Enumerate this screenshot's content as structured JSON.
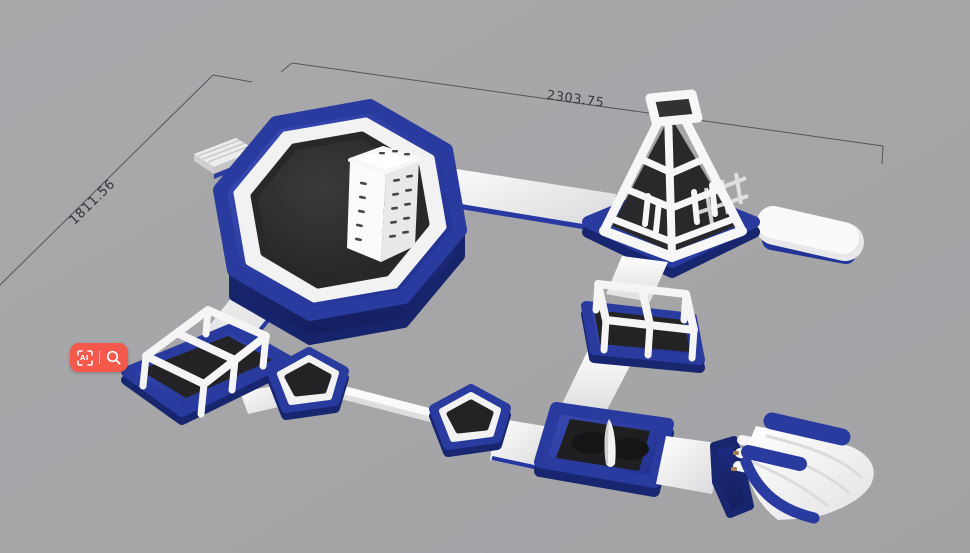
{
  "canvas": {
    "width": 970,
    "height": 553,
    "background_color": "#a6a6a9"
  },
  "annotations": {
    "width_label": "2303.75",
    "height_label": "1811.56",
    "line_color": "#56565a",
    "text_color": "#36363a"
  },
  "palette": {
    "inflatable_blue": "#2a3b9f",
    "inflatable_blue_dark": "#18266f",
    "inflatable_white": "#f2f2f3",
    "mat_dark": "#232325",
    "floor_gray": "#a6a6a9"
  },
  "toolbar": {
    "background_color": "#f4594c",
    "ai_label": "AI",
    "items": [
      {
        "name": "ai-translate",
        "icon": "ai-frame-icon"
      },
      {
        "name": "image-search",
        "icon": "magnifier-icon"
      }
    ]
  },
  "scene": {
    "description": "3D render of inflatable floating water park",
    "objects": [
      {
        "name": "octagon-trampoline"
      },
      {
        "name": "climbing-tower"
      },
      {
        "name": "boarding-dock"
      },
      {
        "name": "walkway-octagon-to-pyramid"
      },
      {
        "name": "climbing-pyramid"
      },
      {
        "name": "float-capsule"
      },
      {
        "name": "lattice-cube-left"
      },
      {
        "name": "lattice-cube-right"
      },
      {
        "name": "walkway-octagon-to-cube"
      },
      {
        "name": "pentagon-stepper-1"
      },
      {
        "name": "pentagon-stepper-2"
      },
      {
        "name": "balance-beam"
      },
      {
        "name": "splash-trampoline-with-wedge"
      },
      {
        "name": "water-slide"
      }
    ]
  }
}
